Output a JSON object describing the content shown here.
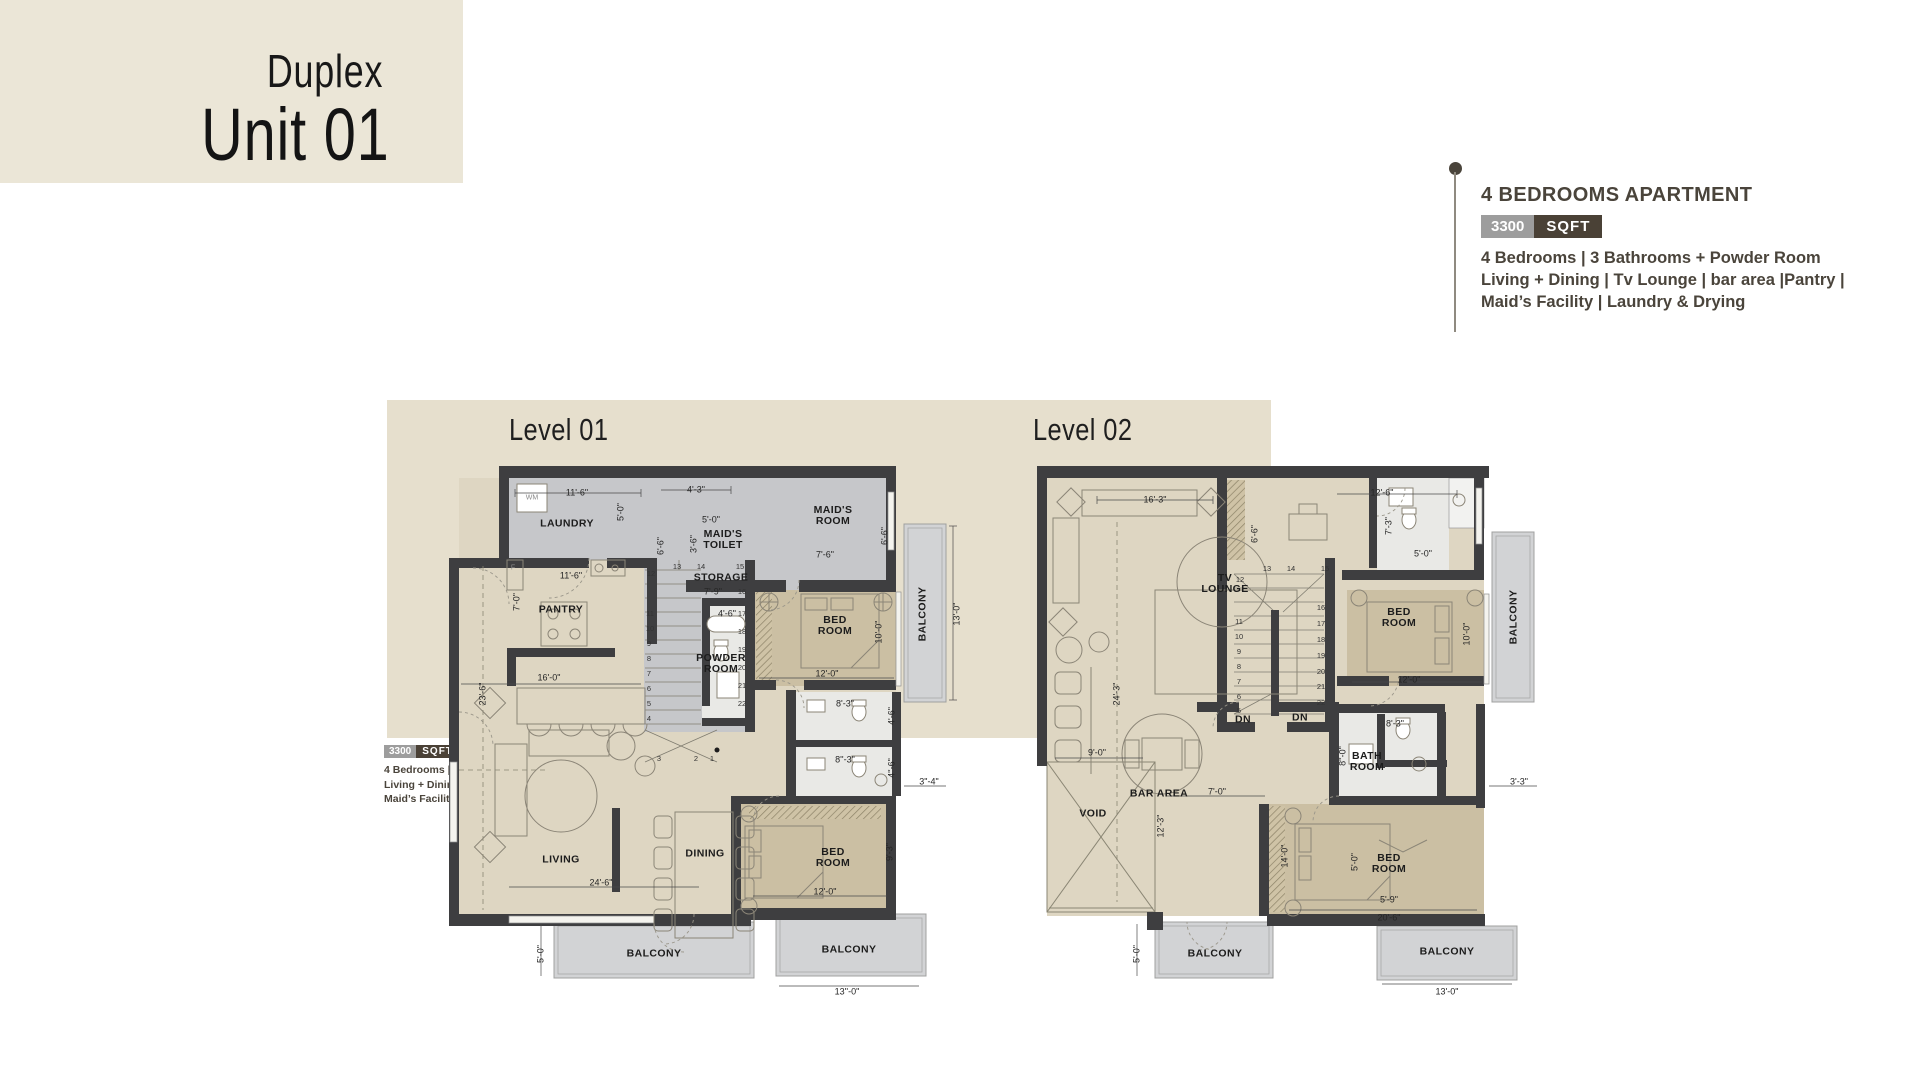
{
  "header": {
    "title_line1": "Duplex",
    "title_line2": "Unit 01"
  },
  "info": {
    "heading": "4 BEDROOMS APARTMENT",
    "badge_value": "3300",
    "badge_unit": "SQFT",
    "line1": "4 Bedrooms | 3 Bathrooms + Powder Room",
    "line2": "Living + Dining | Tv Lounge | bar area |Pantry |",
    "line3": "Maid’s Facility | Laundry & Drying"
  },
  "levels": {
    "level1_title": "Level 01",
    "level2_title": "Level 02"
  },
  "colors": {
    "header_bg": "#ebe6d7",
    "panel_bg": "#e6dfcd",
    "wall": "#3e3e40",
    "floor_beige": "#ded6c2",
    "floor_gray": "#c6c7ca",
    "floor_tan": "#cbbfa3",
    "floor_bath": "#e9e9e6",
    "balcony": "#d2d3d5",
    "badge_value_bg": "#9d9d9d",
    "badge_unit_bg": "#4a4136",
    "text_dark": "#4a443b"
  },
  "plan1": {
    "name": "Level 01 floor plan",
    "labels": [
      {
        "t": "LAUNDRY",
        "x": 118,
        "y": 62,
        "c": "room"
      },
      {
        "t": "WM",
        "x": 83,
        "y": 36,
        "c": "tiny"
      },
      {
        "t": "11'-6\"",
        "x": 128,
        "y": 31
      },
      {
        "t": "5'-0\"",
        "x": 172,
        "y": 50,
        "r": -90
      },
      {
        "t": "4'-3\"",
        "x": 247,
        "y": 28
      },
      {
        "t": "6'-6\"",
        "x": 212,
        "y": 84,
        "r": -90
      },
      {
        "t": "5'-0\"",
        "x": 262,
        "y": 58
      },
      {
        "t": "3'-6\"",
        "x": 245,
        "y": 82,
        "r": -90
      },
      {
        "t": "MAID'S\nTOILET",
        "x": 274,
        "y": 78,
        "c": "room"
      },
      {
        "t": "MAID'S\nROOM",
        "x": 384,
        "y": 54,
        "c": "room"
      },
      {
        "t": "7'-6\"",
        "x": 376,
        "y": 93
      },
      {
        "t": "6'-6\"",
        "x": 436,
        "y": 74,
        "r": -90
      },
      {
        "t": "F",
        "x": 64,
        "y": 106,
        "c": "tiny"
      },
      {
        "t": "11'-6\"",
        "x": 122,
        "y": 114
      },
      {
        "t": "PANTRY",
        "x": 112,
        "y": 148,
        "c": "room"
      },
      {
        "t": "7'-0\"",
        "x": 68,
        "y": 140,
        "r": -90
      },
      {
        "t": "STORAGE",
        "x": 272,
        "y": 116,
        "c": "room"
      },
      {
        "t": "7'-9\"",
        "x": 264,
        "y": 130
      },
      {
        "t": "4'-6\"",
        "x": 278,
        "y": 152
      },
      {
        "t": "POWDER\nROOM",
        "x": 272,
        "y": 202,
        "c": "room"
      },
      {
        "t": "BED\nROOM",
        "x": 386,
        "y": 164,
        "c": "room"
      },
      {
        "t": "10'-0\"",
        "x": 430,
        "y": 170,
        "r": -90
      },
      {
        "t": "12'-0\"",
        "x": 378,
        "y": 212
      },
      {
        "t": "16'-0\"",
        "x": 100,
        "y": 216
      },
      {
        "t": "23'-6\"",
        "x": 34,
        "y": 232,
        "r": -90
      },
      {
        "t": "BALCONY",
        "x": 474,
        "y": 152,
        "r": -90,
        "c": "room"
      },
      {
        "t": "13'-0\"",
        "x": 508,
        "y": 152,
        "r": -90
      },
      {
        "t": "8'-3\"",
        "x": 396,
        "y": 242
      },
      {
        "t": "4'-6\"",
        "x": 443,
        "y": 254,
        "r": -90
      },
      {
        "t": "8''-3\"",
        "x": 396,
        "y": 298
      },
      {
        "t": "4''-6\"",
        "x": 443,
        "y": 306,
        "r": -90
      },
      {
        "t": "3\"-4\"",
        "x": 480,
        "y": 320
      },
      {
        "t": "DINING",
        "x": 256,
        "y": 392,
        "c": "room"
      },
      {
        "t": "LIVING",
        "x": 112,
        "y": 398,
        "c": "room"
      },
      {
        "t": "24'-6\"",
        "x": 152,
        "y": 421
      },
      {
        "t": "BED\nROOM",
        "x": 384,
        "y": 396,
        "c": "room"
      },
      {
        "t": "9'-3\"",
        "x": 441,
        "y": 390,
        "r": -90
      },
      {
        "t": "12'-0\"",
        "x": 376,
        "y": 430
      },
      {
        "t": "BALCONY",
        "x": 205,
        "y": 492,
        "c": "room"
      },
      {
        "t": "5'-0\"",
        "x": 92,
        "y": 492,
        "r": -90
      },
      {
        "t": "BALCONY",
        "x": 400,
        "y": 488,
        "c": "room"
      },
      {
        "t": "13''-0\"",
        "x": 398,
        "y": 530
      },
      {
        "t": "12",
        "x": 202,
        "y": 112,
        "c": "num"
      },
      {
        "t": "13",
        "x": 228,
        "y": 105,
        "c": "num"
      },
      {
        "t": "14",
        "x": 252,
        "y": 105,
        "c": "num"
      },
      {
        "t": "15",
        "x": 291,
        "y": 105,
        "c": "num"
      },
      {
        "t": "11",
        "x": 201,
        "y": 152,
        "c": "num"
      },
      {
        "t": "10",
        "x": 201,
        "y": 167,
        "c": "num"
      },
      {
        "t": "9",
        "x": 200,
        "y": 182,
        "c": "num"
      },
      {
        "t": "8",
        "x": 200,
        "y": 197,
        "c": "num"
      },
      {
        "t": "7",
        "x": 200,
        "y": 212,
        "c": "num"
      },
      {
        "t": "6",
        "x": 200,
        "y": 227,
        "c": "num"
      },
      {
        "t": "5",
        "x": 200,
        "y": 242,
        "c": "num"
      },
      {
        "t": "4",
        "x": 200,
        "y": 257,
        "c": "num"
      },
      {
        "t": "3",
        "x": 210,
        "y": 297,
        "c": "num"
      },
      {
        "t": "2",
        "x": 247,
        "y": 297,
        "c": "num"
      },
      {
        "t": "1",
        "x": 263,
        "y": 297,
        "c": "num"
      },
      {
        "t": "16",
        "x": 293,
        "y": 130,
        "c": "num"
      },
      {
        "t": "17",
        "x": 293,
        "y": 152,
        "c": "num"
      },
      {
        "t": "18",
        "x": 293,
        "y": 170,
        "c": "num"
      },
      {
        "t": "19",
        "x": 293,
        "y": 188,
        "c": "num"
      },
      {
        "t": "20",
        "x": 293,
        "y": 206,
        "c": "num"
      },
      {
        "t": "21",
        "x": 293,
        "y": 224,
        "c": "num"
      },
      {
        "t": "22",
        "x": 293,
        "y": 242,
        "c": "num"
      }
    ]
  },
  "plan2": {
    "name": "Level 02 floor plan",
    "labels": [
      {
        "t": "16'-3\"",
        "x": 118,
        "y": 38
      },
      {
        "t": "TV\nLOUNGE",
        "x": 188,
        "y": 122,
        "c": "room"
      },
      {
        "t": "24'-3\"",
        "x": 80,
        "y": 232,
        "r": -90
      },
      {
        "t": "6'-6\"",
        "x": 218,
        "y": 72,
        "r": -90
      },
      {
        "t": "12'-6\"",
        "x": 345,
        "y": 31
      },
      {
        "t": "7'-3\"",
        "x": 352,
        "y": 64,
        "r": -90
      },
      {
        "t": "5'-0\"",
        "x": 386,
        "y": 92
      },
      {
        "t": "BED\nROOM",
        "x": 362,
        "y": 156,
        "c": "room"
      },
      {
        "t": "10'-0\"",
        "x": 430,
        "y": 172,
        "r": -90
      },
      {
        "t": "12'-0\"",
        "x": 372,
        "y": 218
      },
      {
        "t": "BALCONY",
        "x": 477,
        "y": 155,
        "r": -90,
        "c": "room"
      },
      {
        "t": "BAR AREA",
        "x": 122,
        "y": 332,
        "c": "room"
      },
      {
        "t": "9'-0\"",
        "x": 60,
        "y": 291
      },
      {
        "t": "VOID",
        "x": 56,
        "y": 352,
        "c": "room"
      },
      {
        "t": "12'-3\"",
        "x": 124,
        "y": 364,
        "r": -90
      },
      {
        "t": "7'-0\"",
        "x": 180,
        "y": 330
      },
      {
        "t": "DN",
        "x": 206,
        "y": 258,
        "c": "room"
      },
      {
        "t": "DN",
        "x": 263,
        "y": 256,
        "c": "room"
      },
      {
        "t": "BATH\nROOM",
        "x": 330,
        "y": 300,
        "c": "room"
      },
      {
        "t": "8'-3\"",
        "x": 358,
        "y": 262
      },
      {
        "t": "8''-0\"",
        "x": 306,
        "y": 294,
        "r": -90
      },
      {
        "t": "3'-3\"",
        "x": 482,
        "y": 320
      },
      {
        "t": "BED\nROOM",
        "x": 352,
        "y": 402,
        "c": "room"
      },
      {
        "t": "14'-0\"",
        "x": 248,
        "y": 394,
        "r": -90
      },
      {
        "t": "5'-0\"",
        "x": 318,
        "y": 400,
        "r": -90
      },
      {
        "t": "5'-9\"",
        "x": 352,
        "y": 438
      },
      {
        "t": "20'-6\"",
        "x": 352,
        "y": 456
      },
      {
        "t": "BALCONY",
        "x": 178,
        "y": 492,
        "c": "room"
      },
      {
        "t": "5'-0\"",
        "x": 100,
        "y": 492,
        "r": -90
      },
      {
        "t": "BALCONY",
        "x": 410,
        "y": 490,
        "c": "room"
      },
      {
        "t": "13'-0\"",
        "x": 410,
        "y": 530
      },
      {
        "t": "12",
        "x": 203,
        "y": 118,
        "c": "num"
      },
      {
        "t": "13",
        "x": 230,
        "y": 107,
        "c": "num"
      },
      {
        "t": "14",
        "x": 254,
        "y": 107,
        "c": "num"
      },
      {
        "t": "15",
        "x": 288,
        "y": 107,
        "c": "num"
      },
      {
        "t": "11",
        "x": 202,
        "y": 160,
        "c": "num"
      },
      {
        "t": "10",
        "x": 202,
        "y": 175,
        "c": "num"
      },
      {
        "t": "9",
        "x": 202,
        "y": 190,
        "c": "num"
      },
      {
        "t": "8",
        "x": 202,
        "y": 205,
        "c": "num"
      },
      {
        "t": "7",
        "x": 202,
        "y": 220,
        "c": "num"
      },
      {
        "t": "6",
        "x": 202,
        "y": 235,
        "c": "num"
      },
      {
        "t": "5",
        "x": 202,
        "y": 249,
        "c": "num"
      },
      {
        "t": "16",
        "x": 284,
        "y": 146,
        "c": "num"
      },
      {
        "t": "17",
        "x": 284,
        "y": 162,
        "c": "num"
      },
      {
        "t": "18",
        "x": 284,
        "y": 178,
        "c": "num"
      },
      {
        "t": "19",
        "x": 284,
        "y": 194,
        "c": "num"
      },
      {
        "t": "20",
        "x": 284,
        "y": 210,
        "c": "num"
      },
      {
        "t": "21",
        "x": 284,
        "y": 225,
        "c": "num"
      },
      {
        "t": "22",
        "x": 284,
        "y": 241,
        "c": "num"
      }
    ]
  }
}
